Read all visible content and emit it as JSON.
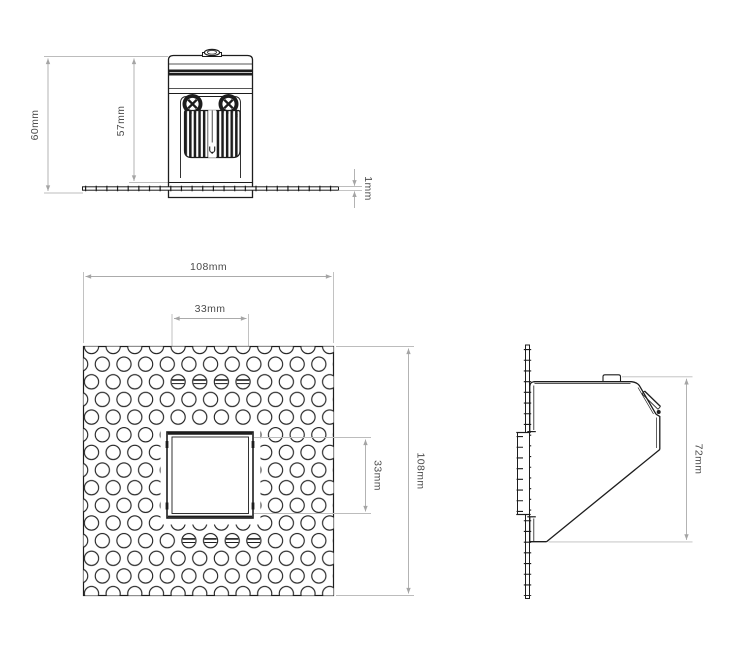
{
  "drawing": {
    "type": "technical-dimension-drawing",
    "views": {
      "front": {
        "label": "front elevation",
        "dims": {
          "total_height": "60mm",
          "body_height": "57mm",
          "flange_thickness": "1mm"
        }
      },
      "face": {
        "label": "face plate",
        "dims": {
          "plate_width": "108mm",
          "cutout_width": "33mm",
          "cutout_height": "33mm",
          "plate_height": "108mm"
        }
      },
      "side": {
        "label": "side profile",
        "dims": {
          "depth": "72mm"
        }
      }
    },
    "colors": {
      "line": "#1d1d1d",
      "dim_line": "#ababab",
      "extension_line": "#bcbcbc",
      "label_text": "#4c4c4c",
      "background": "#ffffff"
    }
  }
}
